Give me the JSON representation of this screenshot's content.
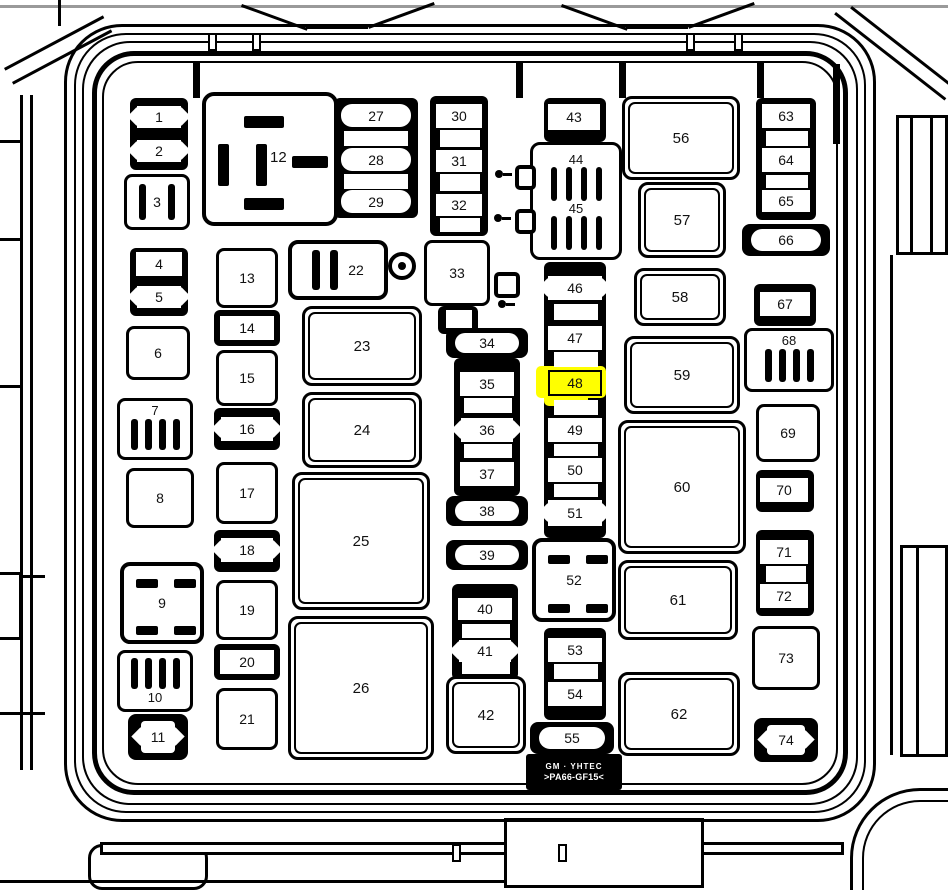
{
  "diagram": {
    "type": "fuse-box-diagram",
    "highlight": {
      "fuse": "48",
      "color": "#ffff00"
    },
    "marking": {
      "line1": "GM · YHTEC",
      "line2": ">PA66-GF15<"
    },
    "fuses": [
      {
        "label": "1",
        "type": "wing",
        "x": 137,
        "y": 106,
        "w": 44,
        "h": 22
      },
      {
        "label": "2",
        "type": "wing",
        "x": 137,
        "y": 140,
        "w": 44,
        "h": 22
      },
      {
        "label": "3",
        "type": "slots2",
        "x": 124,
        "y": 174,
        "w": 66,
        "h": 56
      },
      {
        "label": "4",
        "type": "fuse",
        "x": 136,
        "y": 252,
        "w": 46,
        "h": 24
      },
      {
        "label": "5",
        "type": "wing",
        "x": 137,
        "y": 286,
        "w": 44,
        "h": 22
      },
      {
        "label": "6",
        "type": "box",
        "x": 126,
        "y": 326,
        "w": 64,
        "h": 54
      },
      {
        "label": "7",
        "type": "slots4",
        "x": 117,
        "y": 398,
        "w": 76,
        "h": 62,
        "lp": "top"
      },
      {
        "label": "8",
        "type": "box",
        "x": 126,
        "y": 468,
        "w": 68,
        "h": 60
      },
      {
        "label": "9",
        "type": "grid4",
        "x": 120,
        "y": 562,
        "w": 84,
        "h": 82
      },
      {
        "label": "10",
        "type": "slots4",
        "x": 117,
        "y": 650,
        "w": 76,
        "h": 62,
        "lp": "bottom"
      },
      {
        "label": "11",
        "type": "pillwing",
        "x": 128,
        "y": 714,
        "w": 60,
        "h": 46
      },
      {
        "label": "12",
        "type": "relay12",
        "x": 202,
        "y": 92,
        "w": 136,
        "h": 134
      },
      {
        "label": "13",
        "type": "box",
        "x": 216,
        "y": 248,
        "w": 62,
        "h": 60
      },
      {
        "label": "14",
        "type": "fuse",
        "x": 220,
        "y": 316,
        "w": 54,
        "h": 24
      },
      {
        "label": "15",
        "type": "box",
        "x": 216,
        "y": 350,
        "w": 62,
        "h": 56
      },
      {
        "label": "16",
        "type": "wing",
        "x": 221,
        "y": 417,
        "w": 52,
        "h": 24
      },
      {
        "label": "17",
        "type": "box",
        "x": 216,
        "y": 462,
        "w": 62,
        "h": 62
      },
      {
        "label": "18",
        "type": "wing",
        "x": 221,
        "y": 538,
        "w": 52,
        "h": 24
      },
      {
        "label": "19",
        "type": "box",
        "x": 216,
        "y": 580,
        "w": 62,
        "h": 60
      },
      {
        "label": "20",
        "type": "fuse",
        "x": 220,
        "y": 650,
        "w": 54,
        "h": 24
      },
      {
        "label": "21",
        "type": "box",
        "x": 216,
        "y": 688,
        "w": 62,
        "h": 62
      },
      {
        "label": "22",
        "type": "slots2h",
        "x": 288,
        "y": 240,
        "w": 100,
        "h": 60
      },
      {
        "label": "23",
        "type": "boxd",
        "x": 302,
        "y": 306,
        "w": 120,
        "h": 80
      },
      {
        "label": "24",
        "type": "boxd",
        "x": 302,
        "y": 392,
        "w": 120,
        "h": 76
      },
      {
        "label": "25",
        "type": "boxd",
        "x": 292,
        "y": 472,
        "w": 138,
        "h": 138
      },
      {
        "label": "26",
        "type": "boxd",
        "x": 288,
        "y": 616,
        "w": 146,
        "h": 144
      },
      {
        "label": "27",
        "type": "pillinline",
        "x": 341,
        "y": 104,
        "w": 70,
        "h": 23
      },
      {
        "label": "28",
        "type": "pillinline",
        "x": 341,
        "y": 148,
        "w": 70,
        "h": 23
      },
      {
        "label": "29",
        "type": "pillinline",
        "x": 341,
        "y": 190,
        "w": 70,
        "h": 23
      },
      {
        "label": "30",
        "type": "fuse",
        "x": 436,
        "y": 104,
        "w": 46,
        "h": 24
      },
      {
        "label": "31",
        "type": "fuse",
        "x": 436,
        "y": 150,
        "w": 46,
        "h": 22
      },
      {
        "label": "32",
        "type": "fuse",
        "x": 436,
        "y": 194,
        "w": 46,
        "h": 22
      },
      {
        "label": "33",
        "type": "box",
        "x": 424,
        "y": 240,
        "w": 66,
        "h": 66
      },
      {
        "label": "34",
        "type": "pill",
        "x": 446,
        "y": 328,
        "w": 82,
        "h": 30
      },
      {
        "label": "35",
        "type": "fuse",
        "x": 460,
        "y": 372,
        "w": 54,
        "h": 24
      },
      {
        "label": "36",
        "type": "wing",
        "x": 461,
        "y": 418,
        "w": 52,
        "h": 24
      },
      {
        "label": "37",
        "type": "fuse",
        "x": 460,
        "y": 462,
        "w": 54,
        "h": 24
      },
      {
        "label": "38",
        "type": "pill",
        "x": 446,
        "y": 496,
        "w": 82,
        "h": 30
      },
      {
        "label": "39",
        "type": "pill",
        "x": 446,
        "y": 540,
        "w": 82,
        "h": 30
      },
      {
        "label": "40",
        "type": "fuse",
        "x": 458,
        "y": 598,
        "w": 54,
        "h": 22
      },
      {
        "label": "41",
        "type": "wing",
        "x": 459,
        "y": 640,
        "w": 52,
        "h": 22
      },
      {
        "label": "42",
        "type": "boxd",
        "x": 446,
        "y": 676,
        "w": 80,
        "h": 78
      },
      {
        "label": "43",
        "type": "fuse",
        "x": 548,
        "y": 104,
        "w": 52,
        "h": 26
      },
      {
        "labels": [
          "44",
          "45"
        ],
        "type": "dualrelay",
        "x": 530,
        "y": 142,
        "w": 92,
        "h": 118
      },
      {
        "label": "46",
        "type": "wing",
        "x": 548,
        "y": 276,
        "w": 54,
        "h": 24
      },
      {
        "label": "47",
        "type": "fuse",
        "x": 548,
        "y": 326,
        "w": 54,
        "h": 24
      },
      {
        "label": "48",
        "type": "fusehl",
        "x": 548,
        "y": 370,
        "w": 54,
        "h": 26
      },
      {
        "label": "49",
        "type": "fuse",
        "x": 548,
        "y": 418,
        "w": 54,
        "h": 24
      },
      {
        "label": "50",
        "type": "fuse",
        "x": 548,
        "y": 458,
        "w": 54,
        "h": 24
      },
      {
        "label": "51",
        "type": "wing",
        "x": 548,
        "y": 500,
        "w": 54,
        "h": 26
      },
      {
        "label": "52",
        "type": "grid4",
        "x": 532,
        "y": 538,
        "w": 84,
        "h": 84
      },
      {
        "label": "53",
        "type": "fuse",
        "x": 548,
        "y": 638,
        "w": 54,
        "h": 24
      },
      {
        "label": "54",
        "type": "fuse",
        "x": 548,
        "y": 682,
        "w": 54,
        "h": 24
      },
      {
        "label": "55",
        "type": "pill",
        "x": 530,
        "y": 722,
        "w": 84,
        "h": 32
      },
      {
        "label": "56",
        "type": "boxd",
        "x": 622,
        "y": 96,
        "w": 118,
        "h": 84
      },
      {
        "label": "57",
        "type": "boxd",
        "x": 638,
        "y": 182,
        "w": 88,
        "h": 76
      },
      {
        "label": "58",
        "type": "boxd",
        "x": 634,
        "y": 268,
        "w": 92,
        "h": 58
      },
      {
        "label": "59",
        "type": "boxd",
        "x": 624,
        "y": 336,
        "w": 116,
        "h": 78
      },
      {
        "label": "60",
        "type": "boxd",
        "x": 618,
        "y": 420,
        "w": 128,
        "h": 134
      },
      {
        "label": "61",
        "type": "boxd",
        "x": 618,
        "y": 560,
        "w": 120,
        "h": 80
      },
      {
        "label": "62",
        "type": "boxd",
        "x": 618,
        "y": 672,
        "w": 122,
        "h": 84
      },
      {
        "label": "63",
        "type": "fuse",
        "x": 762,
        "y": 104,
        "w": 48,
        "h": 24
      },
      {
        "label": "64",
        "type": "fuse",
        "x": 762,
        "y": 148,
        "w": 48,
        "h": 24
      },
      {
        "label": "65",
        "type": "fuse",
        "x": 762,
        "y": 190,
        "w": 48,
        "h": 22
      },
      {
        "label": "66",
        "type": "pill",
        "x": 742,
        "y": 224,
        "w": 88,
        "h": 32
      },
      {
        "label": "67",
        "type": "fuse",
        "x": 760,
        "y": 292,
        "w": 50,
        "h": 24
      },
      {
        "label": "68",
        "type": "slots4",
        "x": 744,
        "y": 328,
        "w": 90,
        "h": 64,
        "lp": "top"
      },
      {
        "label": "69",
        "type": "box",
        "x": 756,
        "y": 404,
        "w": 64,
        "h": 58
      },
      {
        "label": "70",
        "type": "fuse",
        "x": 760,
        "y": 478,
        "w": 48,
        "h": 24
      },
      {
        "label": "71",
        "type": "fuse",
        "x": 760,
        "y": 540,
        "w": 48,
        "h": 24
      },
      {
        "label": "72",
        "type": "fuse",
        "x": 760,
        "y": 584,
        "w": 48,
        "h": 24
      },
      {
        "label": "73",
        "type": "box",
        "x": 752,
        "y": 626,
        "w": 68,
        "h": 64
      },
      {
        "label": "74",
        "type": "pillwing",
        "x": 754,
        "y": 718,
        "w": 64,
        "h": 44
      }
    ],
    "geometry": {
      "rails": [
        [
          130,
          98,
          58,
          72
        ],
        [
          130,
          248,
          58,
          68
        ],
        [
          214,
          310,
          66,
          36
        ],
        [
          214,
          408,
          66,
          42
        ],
        [
          214,
          530,
          66,
          42
        ],
        [
          214,
          644,
          66,
          36
        ],
        [
          334,
          98,
          84,
          120
        ],
        [
          430,
          96,
          58,
          140
        ],
        [
          438,
          306,
          40,
          28
        ],
        [
          454,
          358,
          66,
          138
        ],
        [
          452,
          584,
          66,
          96
        ],
        [
          544,
          98,
          62,
          44
        ],
        [
          544,
          262,
          62,
          276
        ],
        [
          544,
          628,
          62,
          92
        ],
        [
          756,
          98,
          60,
          122
        ],
        [
          754,
          284,
          62,
          42
        ],
        [
          756,
          470,
          58,
          42
        ],
        [
          756,
          530,
          58,
          86
        ]
      ],
      "blanks": [
        [
          344,
          131,
          64,
          15
        ],
        [
          344,
          174,
          64,
          15
        ],
        [
          440,
          130,
          40,
          17
        ],
        [
          440,
          174,
          40,
          17
        ],
        [
          440,
          218,
          40,
          14
        ],
        [
          446,
          310,
          26,
          18
        ],
        [
          464,
          398,
          48,
          15
        ],
        [
          464,
          444,
          48,
          14
        ],
        [
          462,
          624,
          48,
          14
        ],
        [
          462,
          662,
          48,
          12
        ],
        [
          554,
          304,
          44,
          16
        ],
        [
          554,
          352,
          44,
          15
        ],
        [
          554,
          400,
          44,
          15
        ],
        [
          554,
          444,
          44,
          12
        ],
        [
          554,
          484,
          44,
          13
        ],
        [
          554,
          664,
          44,
          15
        ],
        [
          766,
          131,
          42,
          15
        ],
        [
          766,
          175,
          42,
          13
        ],
        [
          766,
          566,
          40,
          16
        ]
      ],
      "highlight_rects": [
        [
          536,
          366,
          70,
          32
        ],
        [
          544,
          392,
          44,
          14
        ]
      ],
      "bolts": [
        [
          388,
          252,
          28
        ]
      ],
      "connectors": [
        [
          494,
          272,
          26,
          26
        ],
        [
          515,
          165,
          21,
          25
        ],
        [
          515,
          209,
          21,
          25
        ]
      ],
      "screws": [
        [
          498,
          300
        ],
        [
          495,
          170
        ],
        [
          494,
          214
        ]
      ]
    }
  }
}
